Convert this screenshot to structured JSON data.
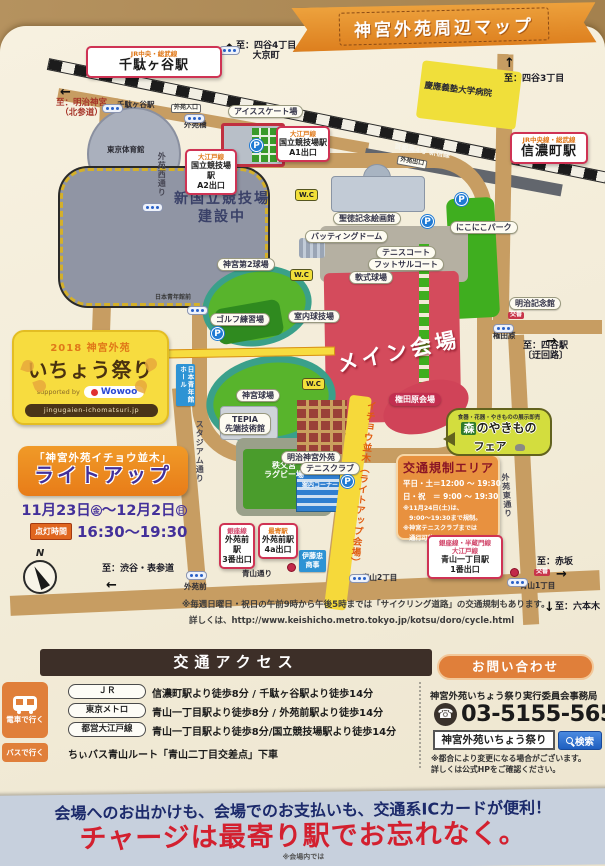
{
  "title_banner": {
    "text": "神宮外苑周辺マップ"
  },
  "colors": {
    "accent_orange": "#e0812f",
    "venue_red": "#d04358",
    "road_tan": "#c79d62",
    "field_green": "#58b42c",
    "highlight_yellow": "#f6d93a",
    "banner_red": "#d3202f",
    "banner_navy": "#1c2a6b"
  },
  "map": {
    "wc_label": "W.C",
    "parking_label": "P",
    "compass_label": "N",
    "labels": [
      {
        "n": "to-meiji-jingu",
        "t": "至：明治神宮\n（北参道）",
        "x": 56,
        "y": 99,
        "c": "dir-red"
      },
      {
        "n": "sendagaya-sub-label",
        "t": "千駄ヶ谷駅",
        "x": 117,
        "y": 101,
        "c": "small"
      },
      {
        "n": "to-yotsuya-4chome",
        "t": "至：四谷4丁目\n大京町",
        "x": 236,
        "y": 41,
        "c": "dir"
      },
      {
        "n": "ice-skate-label",
        "t": "アイススケート場",
        "x": 228,
        "y": 105,
        "c": "pill"
      },
      {
        "n": "gaien-entrance-tag",
        "t": "外苑入口",
        "x": 171,
        "y": 104,
        "c": "tag"
      },
      {
        "n": "gaien-bashi-label",
        "t": "外苑橋",
        "x": 184,
        "y": 121,
        "c": "small"
      },
      {
        "n": "gaien-nishi-street-label",
        "t": "外苑西通り",
        "x": 157,
        "y": 152,
        "c": "vtext",
        "h": 60
      },
      {
        "n": "tokyo-gym-label",
        "t": "東京体育館",
        "x": 107,
        "y": 146,
        "c": "small"
      },
      {
        "n": "new-stadium-label",
        "t": "新国立競技場\n建設中",
        "x": 152,
        "y": 190,
        "c": "bigdark",
        "w": 140
      },
      {
        "n": "shuto-expwy-label",
        "t": "首都高4号 新宿線",
        "x": 394,
        "y": 147,
        "c": "road-name",
        "r": 10
      },
      {
        "n": "gaien-exit-tag",
        "t": "外苑出口",
        "x": 397,
        "y": 158,
        "c": "tag",
        "r": 10
      },
      {
        "n": "to-yotsuya-3chome",
        "t": "至：四谷3丁目",
        "x": 504,
        "y": 74,
        "c": "dir"
      },
      {
        "n": "keio-hospital-label",
        "t": "慶應義塾大学病院",
        "x": 424,
        "y": 86,
        "c": "plain",
        "r": 7
      },
      {
        "n": "seitoku-gallery-label",
        "t": "聖徳記念絵画館",
        "x": 333,
        "y": 212,
        "c": "pill"
      },
      {
        "n": "nikoniko-park-label",
        "t": "にこにこパーク",
        "x": 450,
        "y": 221,
        "c": "pill"
      },
      {
        "n": "batting-dome-label",
        "t": "バッティングドーム",
        "x": 305,
        "y": 230,
        "c": "pill"
      },
      {
        "n": "tennis-court-label",
        "t": "テニスコート",
        "x": 376,
        "y": 246,
        "c": "pill"
      },
      {
        "n": "futsal-court-label",
        "t": "フットサルコート",
        "x": 368,
        "y": 258,
        "c": "pill"
      },
      {
        "n": "soft-field-label",
        "t": "軟式球場",
        "x": 349,
        "y": 271,
        "c": "pill"
      },
      {
        "n": "jingu-2nd-stadium-label",
        "t": "神宮第2球場",
        "x": 217,
        "y": 258,
        "c": "pill"
      },
      {
        "n": "golf-range-label",
        "t": "ゴルフ練習場",
        "x": 210,
        "y": 313,
        "c": "pill"
      },
      {
        "n": "indoor-gym-label",
        "t": "室内球技場",
        "x": 288,
        "y": 310,
        "c": "pill"
      },
      {
        "n": "seinenkan-mae-label",
        "t": "日本青年館前",
        "x": 155,
        "y": 295,
        "c": "tiny"
      },
      {
        "n": "main-venue-label",
        "t": "メイン会場",
        "x": 336,
        "y": 340,
        "c": "mainlabel",
        "r": -12
      },
      {
        "n": "jingu-stadium-label",
        "t": "神宮球場",
        "x": 236,
        "y": 389,
        "c": "pill"
      },
      {
        "n": "tepia-label",
        "t": "TEPIA\n先端技術館",
        "x": 219,
        "y": 413,
        "c": "pill"
      },
      {
        "n": "stadium-street-label",
        "t": "スタジアム通り",
        "x": 195,
        "y": 420,
        "c": "vtext",
        "h": 70
      },
      {
        "n": "rugby-ground-label",
        "t": "秩父宮\nラグビー場",
        "x": 246,
        "y": 461,
        "c": "white-sm",
        "w": 76
      },
      {
        "n": "meiji-gaien-label",
        "t": "明治神宮外苑",
        "x": 281,
        "y": 451,
        "c": "pill"
      },
      {
        "n": "tennis-club-label",
        "t": "テニスクラブ",
        "x": 300,
        "y": 462,
        "c": "pill"
      },
      {
        "n": "annai-corner-label",
        "t": "案内コーナー",
        "x": 302,
        "y": 483,
        "c": "tiny-white"
      },
      {
        "n": "icho-namiki-label",
        "t": "イチョウ並木（ライトアップ会場）",
        "x": 354,
        "y": 400,
        "c": "vtext-orange",
        "h": 200,
        "r": 6
      },
      {
        "n": "gondawara-venue-label",
        "t": "権田原会場",
        "x": 389,
        "y": 393,
        "c": "venue"
      },
      {
        "n": "gaien-higashi-street-label",
        "t": "外苑東通り",
        "x": 503,
        "y": 473,
        "c": "vtext",
        "h": 70,
        "r": -4
      },
      {
        "n": "meiji-kinenkan-label",
        "t": "明治記念館",
        "x": 509,
        "y": 297,
        "c": "pill"
      },
      {
        "n": "koban-tag-1",
        "t": "交番",
        "x": 508,
        "y": 312,
        "c": "tag-red"
      },
      {
        "n": "gondawara-stop-label",
        "t": "権田原",
        "x": 493,
        "y": 332,
        "c": "small"
      },
      {
        "n": "to-yotsuya-station",
        "t": "至：四谷駅\n〔迂回路〕",
        "x": 523,
        "y": 341,
        "c": "dir"
      },
      {
        "n": "to-akasaka",
        "t": "至：赤坂",
        "x": 537,
        "y": 557,
        "c": "dir"
      },
      {
        "n": "koban-tag-2",
        "t": "交番",
        "x": 534,
        "y": 569,
        "c": "tag-red"
      },
      {
        "n": "aoyama-1chome-label",
        "t": "青山1丁目",
        "x": 520,
        "y": 582,
        "c": "small"
      },
      {
        "n": "to-roppongi",
        "t": "至：六本木",
        "x": 555,
        "y": 602,
        "c": "dir"
      },
      {
        "n": "aoyama-2chome-label",
        "t": "青山2丁目",
        "x": 362,
        "y": 574,
        "c": "small"
      },
      {
        "n": "aoyama-dori-label",
        "t": "青山通り",
        "x": 242,
        "y": 570,
        "c": "small"
      },
      {
        "n": "gaienmae-label",
        "t": "外苑前",
        "x": 184,
        "y": 583,
        "c": "small"
      },
      {
        "n": "to-shibuya-omotesando",
        "t": "至：渋谷・表参道",
        "x": 102,
        "y": 564,
        "c": "dir"
      },
      {
        "n": "cycle-note-line1",
        "t": "※毎週日曜日・祝日の午前9時から午後5時までは「サイクリング道路」の交通規制もあります。",
        "x": 182,
        "y": 601,
        "c": "note"
      },
      {
        "n": "cycle-note-line2",
        "t": "詳しくは、http://www.keishicho.metro.tokyo.jp/kotsu/doro/cycle.html",
        "x": 189,
        "y": 617,
        "c": "note"
      },
      {
        "n": "itochu-label",
        "t": "伊藤忠\n商事",
        "x": 299,
        "y": 550,
        "c": "bluebox"
      },
      {
        "n": "seinenkan-hall-label",
        "t": "日本青年館\nホール",
        "x": 176,
        "y": 364,
        "c": "bluebox-v"
      }
    ],
    "station_boxes": [
      {
        "n": "sendagaya-station-box",
        "x": 86,
        "y": 46,
        "w": 136,
        "lines": [
          {
            "t": "JR中央・総武線",
            "c": "ln-orange"
          },
          {
            "t": "千駄ヶ谷駅",
            "c": "ln-big"
          }
        ]
      },
      {
        "n": "shinanomachi-station-box",
        "x": 510,
        "y": 132,
        "w": 78,
        "lines": [
          {
            "t": "JR中央線・総武線",
            "c": "ln-orange"
          },
          {
            "t": "信濃町駅",
            "c": "ln-big"
          }
        ]
      },
      {
        "n": "kokuritsu-a1-box",
        "x": 276,
        "y": 126,
        "w": 54,
        "lines": [
          {
            "t": "大江戸線",
            "c": "ln-orange"
          },
          {
            "t": "国立競技場駅",
            "c": "ln-sm"
          },
          {
            "t": "A1出口",
            "c": "ln-sm"
          }
        ]
      },
      {
        "n": "kokuritsu-a2-box",
        "x": 185,
        "y": 149,
        "w": 52,
        "lines": [
          {
            "t": "大江戸線",
            "c": "ln-orange"
          },
          {
            "t": "国立競技場駅",
            "c": "ln-sm"
          },
          {
            "t": "A2出口",
            "c": "ln-sm"
          }
        ]
      },
      {
        "n": "gaienmae-exit3-box",
        "x": 219,
        "y": 523,
        "w": 36,
        "lines": [
          {
            "t": "銀座線",
            "c": "ln-pink"
          },
          {
            "t": "外苑前駅",
            "c": "ln-sm"
          },
          {
            "t": "3番出口",
            "c": "ln-sm"
          }
        ]
      },
      {
        "n": "gaienmae-exit4a-box",
        "x": 258,
        "y": 523,
        "w": 40,
        "lines": [
          {
            "t": "最寄駅",
            "c": "ln-orange"
          },
          {
            "t": "外苑前駅",
            "c": "ln-sm"
          },
          {
            "t": "4a出口",
            "c": "ln-sm"
          }
        ]
      },
      {
        "n": "aoyama-itchome-box",
        "x": 427,
        "y": 535,
        "w": 76,
        "lines": [
          {
            "t": "銀座線・半蔵門線",
            "c": "ln-pink"
          },
          {
            "t": "大江戸線",
            "c": "ln-pink"
          },
          {
            "t": "青山一丁目駅",
            "c": "ln-sm"
          },
          {
            "t": "1番出口",
            "c": "ln-sm"
          }
        ]
      }
    ],
    "station_dots": [
      {
        "x": 102,
        "y": 104
      },
      {
        "x": 219,
        "y": 46
      },
      {
        "x": 184,
        "y": 114
      },
      {
        "x": 142,
        "y": 203
      },
      {
        "x": 187,
        "y": 306
      },
      {
        "x": 493,
        "y": 324
      },
      {
        "x": 349,
        "y": 574
      },
      {
        "x": 186,
        "y": 571
      },
      {
        "x": 507,
        "y": 578
      }
    ],
    "parking_icons": [
      {
        "x": 250,
        "y": 139
      },
      {
        "x": 455,
        "y": 193
      },
      {
        "x": 421,
        "y": 215
      },
      {
        "x": 211,
        "y": 327
      },
      {
        "x": 341,
        "y": 475
      }
    ],
    "toilets": [
      {
        "x": 295,
        "y": 189
      },
      {
        "x": 290,
        "y": 269
      },
      {
        "x": 302,
        "y": 378
      }
    ],
    "exit_markers": [
      {
        "x": 287,
        "y": 563
      },
      {
        "x": 510,
        "y": 568
      }
    ],
    "arrows": [
      {
        "n": "arrow-to-meiji-jingu",
        "g": "←",
        "x": 60,
        "y": 85
      },
      {
        "n": "arrow-to-yotsuya-4chome",
        "g": "↑",
        "x": 224,
        "y": 42
      },
      {
        "n": "arrow-to-yotsuya-3chome",
        "g": "↑",
        "x": 504,
        "y": 56
      },
      {
        "n": "arrow-to-yotsuya-station",
        "g": "→",
        "x": 546,
        "y": 334
      },
      {
        "n": "arrow-to-akasaka",
        "g": "→",
        "x": 556,
        "y": 567
      },
      {
        "n": "arrow-to-roppongi",
        "g": "↓",
        "x": 544,
        "y": 600
      },
      {
        "n": "arrow-to-shibuya",
        "g": "←",
        "x": 106,
        "y": 578
      }
    ]
  },
  "festival_card": {
    "year_line": "2018 神宮外苑",
    "title": "いちょう祭り",
    "supported": "supported by",
    "sponsor": "Wowoo",
    "url_ribbon": "jingugaien-ichomatsuri.jp"
  },
  "lightup": {
    "title_line1": "「神宮外苑イチョウ並木」",
    "title_line2": "ライトアップ",
    "date_part1": "11月23日",
    "date_day1": "金",
    "date_tilde": "～",
    "date_part2": "12月2日",
    "date_day2": "日",
    "time_label": "点灯時間",
    "time_value": "16:30～19:30"
  },
  "regulation": {
    "title": "交通規制エリア",
    "line1": "平日・土＝12:00 ～ 19:30",
    "line2": "日・祝　＝ 9:00 ～ 19:30",
    "note1": "※11月24日(土)は、",
    "note2": "　9:00～19:30まで規制。",
    "note3": "※神宮テニスクラブまでは",
    "note4": "　通行可能。"
  },
  "fair_bubble": {
    "tagline": "食器・花器・やきものの展示即売",
    "name_prefix": "森",
    "name_rest": "のやきもの",
    "name_suffix": "フェア"
  },
  "access": {
    "header": "交通アクセス",
    "train_label": "電車で行く",
    "bus_label": "バスで行く",
    "rows": [
      {
        "badge": "ＪＲ",
        "desc": "信濃町駅より徒歩8分 / 千駄ヶ谷駅より徒歩14分"
      },
      {
        "badge": "東京メトロ",
        "desc": "青山一丁目駅より徒歩8分 / 外苑前駅より徒歩14分"
      },
      {
        "badge": "都営大江戸線",
        "desc": "青山一丁目駅より徒歩8分/国立競技場駅より徒歩14分"
      }
    ],
    "bus_desc": "ちぃバス青山ルート「青山二丁目交差点」下車"
  },
  "contact": {
    "header": "お問い合わせ",
    "office": "神宮外苑いちょう祭り実行委員会事務局",
    "phone": "03-5155-5658",
    "search_value": "神宮外苑いちょう祭り",
    "search_button": "検索",
    "note1": "※都合により変更になる場合がございます。",
    "note2": "詳しくは公式HPをご確認ください。"
  },
  "bottom_banner": {
    "line1": "会場へのお出かけも、会場でのお支払いも、交通系ICカードが便利！",
    "line2": "チャージは最寄り駅でお忘れなく。",
    "line3": "※会場内では"
  }
}
